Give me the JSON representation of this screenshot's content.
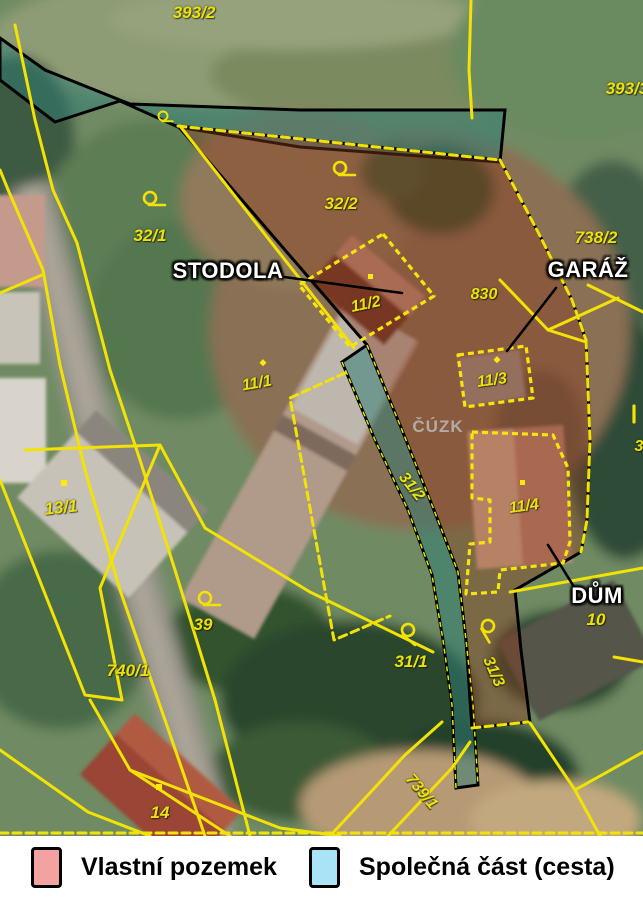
{
  "map": {
    "watermark": "ČÚZK",
    "parcel_labels": [
      {
        "id": "p393-2",
        "text": "393/2"
      },
      {
        "id": "p393-3",
        "text": "393/3"
      },
      {
        "id": "p32-1",
        "text": "32/1"
      },
      {
        "id": "p32-2",
        "text": "32/2"
      },
      {
        "id": "p738-2",
        "text": "738/2"
      },
      {
        "id": "p830",
        "text": "830"
      },
      {
        "id": "p11-2",
        "text": "11/2"
      },
      {
        "id": "p11-1",
        "text": "11/1"
      },
      {
        "id": "p11-3",
        "text": "11/3"
      },
      {
        "id": "p11-4",
        "text": "11/4"
      },
      {
        "id": "p13-1",
        "text": "13/1"
      },
      {
        "id": "p39",
        "text": "39"
      },
      {
        "id": "p740-1",
        "text": "740/1"
      },
      {
        "id": "p31-1",
        "text": "31/1"
      },
      {
        "id": "p31-2",
        "text": "31/2"
      },
      {
        "id": "p31-3",
        "text": "31/3"
      },
      {
        "id": "p739-1",
        "text": "739/1"
      },
      {
        "id": "p10",
        "text": "10"
      },
      {
        "id": "p14",
        "text": "14"
      },
      {
        "id": "p3cut",
        "text": "3"
      }
    ],
    "building_annotations": [
      {
        "id": "stodola",
        "text": "STODOLA"
      },
      {
        "id": "garaz",
        "text": "GARÁŽ"
      },
      {
        "id": "dum",
        "text": "DŮM"
      }
    ],
    "symbols": [
      {
        "name": "land-use-symbol"
      },
      {
        "name": "land-use-symbol"
      },
      {
        "name": "land-use-symbol"
      },
      {
        "name": "land-use-symbol"
      },
      {
        "name": "land-use-symbol"
      },
      {
        "name": "land-use-symbol"
      },
      {
        "name": "boundary-tick-symbol"
      }
    ],
    "colors": {
      "cadastral_line": "#f2e205",
      "parcel_label": "#eae20e",
      "own_overlay": "#8a3c1e",
      "common_overlay": "#2f7d74",
      "overlay_outline": "#000000"
    }
  },
  "legend": {
    "items": [
      {
        "label": "Vlastní pozemek",
        "color": "#f2a2a0"
      },
      {
        "label": "Společná část (cesta)",
        "color": "#a9e4f6"
      }
    ]
  }
}
